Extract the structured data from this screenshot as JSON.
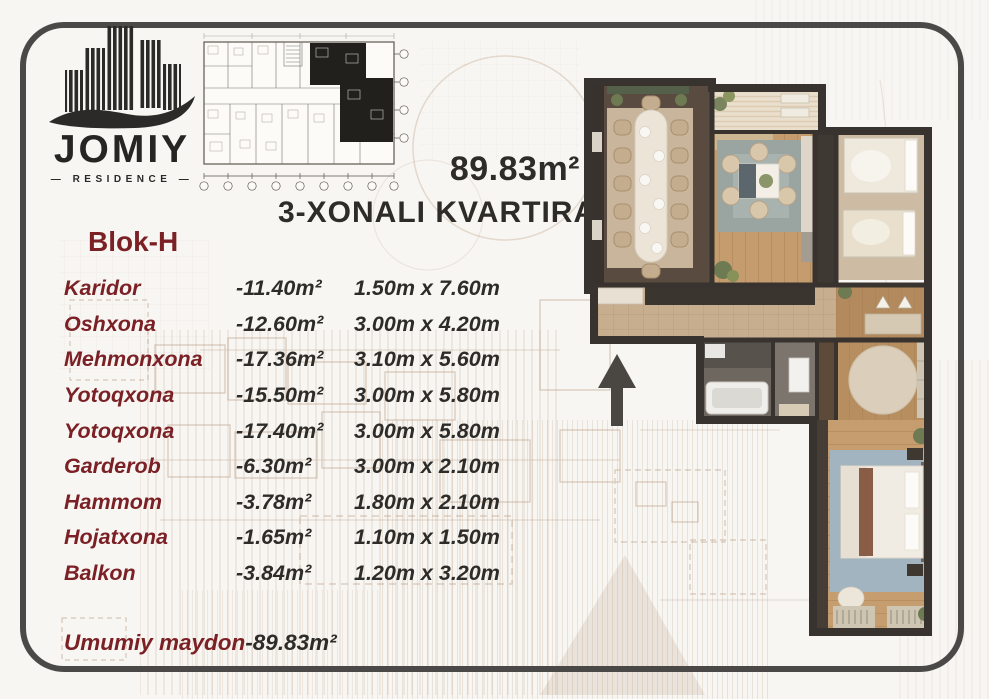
{
  "logo": {
    "title": "JOMIY",
    "subtitle": "— RESIDENCE —"
  },
  "header": {
    "area": "89.83m²",
    "subtitle": "3-XONALI KVARTIRA",
    "block": "Blok-H"
  },
  "rooms": [
    {
      "name": "Karidor",
      "area": "-11.40m²",
      "size": "1.50m x 7.60m"
    },
    {
      "name": "Oshxona",
      "area": "-12.60m²",
      "size": "3.00m x 4.20m"
    },
    {
      "name": "Mehmonxona",
      "area": "-17.36m²",
      "size": "3.10m x 5.60m"
    },
    {
      "name": "Yotoqxona",
      "area": "-15.50m²",
      "size": "3.00m x 5.80m"
    },
    {
      "name": "Yotoqxona",
      "area": "-17.40m²",
      "size": "3.00m x 5.80m"
    },
    {
      "name": "Garderob",
      "area": "-6.30m²",
      "size": "3.00m x 2.10m"
    },
    {
      "name": "Hammom",
      "area": "-3.78m²",
      "size": "1.80m x 2.10m"
    },
    {
      "name": "Hojatxona",
      "area": "-1.65m²",
      "size": "1.10m x 1.50m"
    },
    {
      "name": "Balkon",
      "area": "-3.84m²",
      "size": "1.20m x 3.20m"
    }
  ],
  "total": {
    "label": "Umumiy maydon",
    "value": "-89.83m²"
  },
  "icons": {
    "building_logo": "building-logo-icon",
    "north_arrow": "north-arrow-icon"
  },
  "colors": {
    "accent_maroon": "#7B2025",
    "text_dark": "#2E2C29",
    "frame_gray": "#4B4947",
    "sketch_sepia": "#A8815E",
    "wall_dark": "#3A3430"
  }
}
